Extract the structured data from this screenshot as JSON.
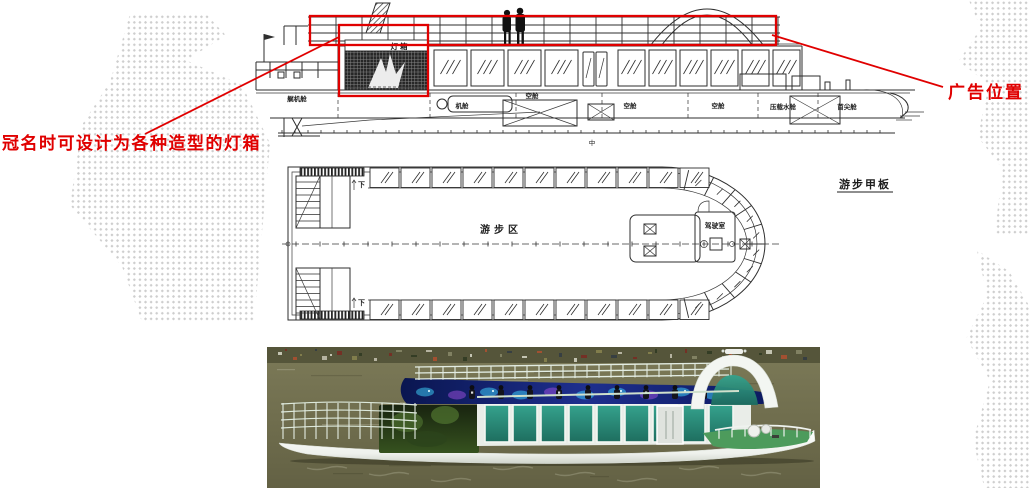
{
  "page": {
    "background": "#ffffff",
    "dot_color": "#c8c8c8",
    "ink_color": "#2e2e2e",
    "accent_red": "#e00000"
  },
  "callouts": {
    "lightbox_note": "冠名时可设计为各种造型的灯箱",
    "ad_note": "广告位置"
  },
  "elevation": {
    "lightbox_label": "灯箱",
    "compartments": [
      "艉机舱",
      "机舱",
      "空舱",
      "空舱",
      "空舱",
      "压载水舱",
      "首尖舱"
    ],
    "baseline_mark": "中",
    "windows_left": 4,
    "windows_right": 6,
    "railing_posts": 19
  },
  "deck_plan": {
    "deck_name": "游步甲板",
    "area_label": "游步区",
    "wheelhouse_label": "驾驶室",
    "stairs_label": "下",
    "windows_per_side": 11,
    "bow_dividers": 11
  },
  "photo": {
    "water_color": "#73714f",
    "shore_color": "#55553a",
    "hull_color": "#f3f5f1",
    "glass_dark": "#1e6e5f",
    "glass_light": "#35a28d",
    "roof_glass": "#9fcfc0",
    "led_dark": "#0a1650",
    "led_mid": "#1e2f8e",
    "glow_cyan": "#3fd8ff",
    "glow_purple": "#a050e0",
    "deck_green": "#4d9b5c",
    "rail_color": "#e4ede3",
    "tree_dark": "#18240f",
    "tree_light": "#36521f"
  }
}
